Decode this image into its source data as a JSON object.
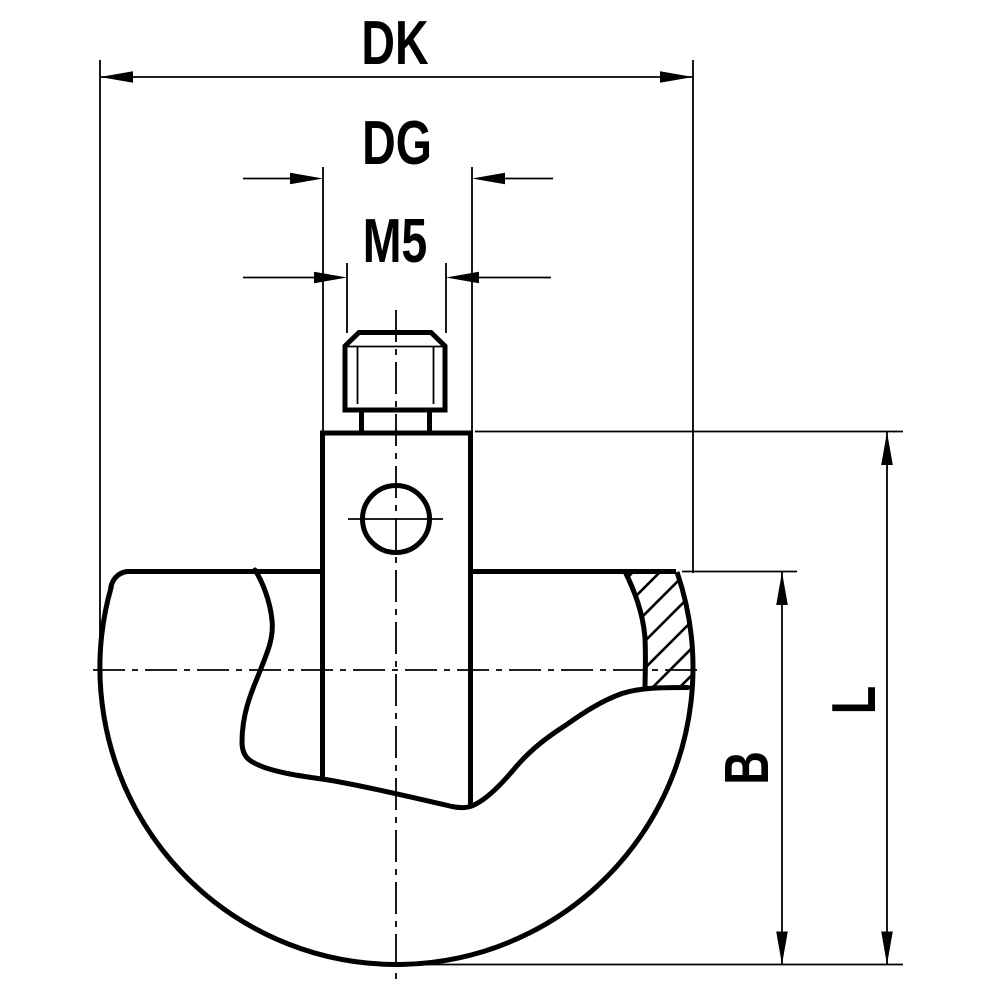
{
  "drawing": {
    "description": "technical dimension drawing of ball stylus with M5 set screw",
    "background_color": "#ffffff",
    "line_color": "#000000",
    "labels": {
      "dk": "DK",
      "dg": "DG",
      "m5": "M5",
      "b": "B",
      "l": "L"
    },
    "dimensions": [
      {
        "id": "dk",
        "label": "DK",
        "orientation": "horizontal"
      },
      {
        "id": "dg",
        "label": "DG",
        "orientation": "horizontal"
      },
      {
        "id": "m5",
        "label": "M5",
        "orientation": "horizontal"
      },
      {
        "id": "b",
        "label": "B",
        "orientation": "vertical"
      },
      {
        "id": "l",
        "label": "L",
        "orientation": "vertical"
      }
    ]
  }
}
